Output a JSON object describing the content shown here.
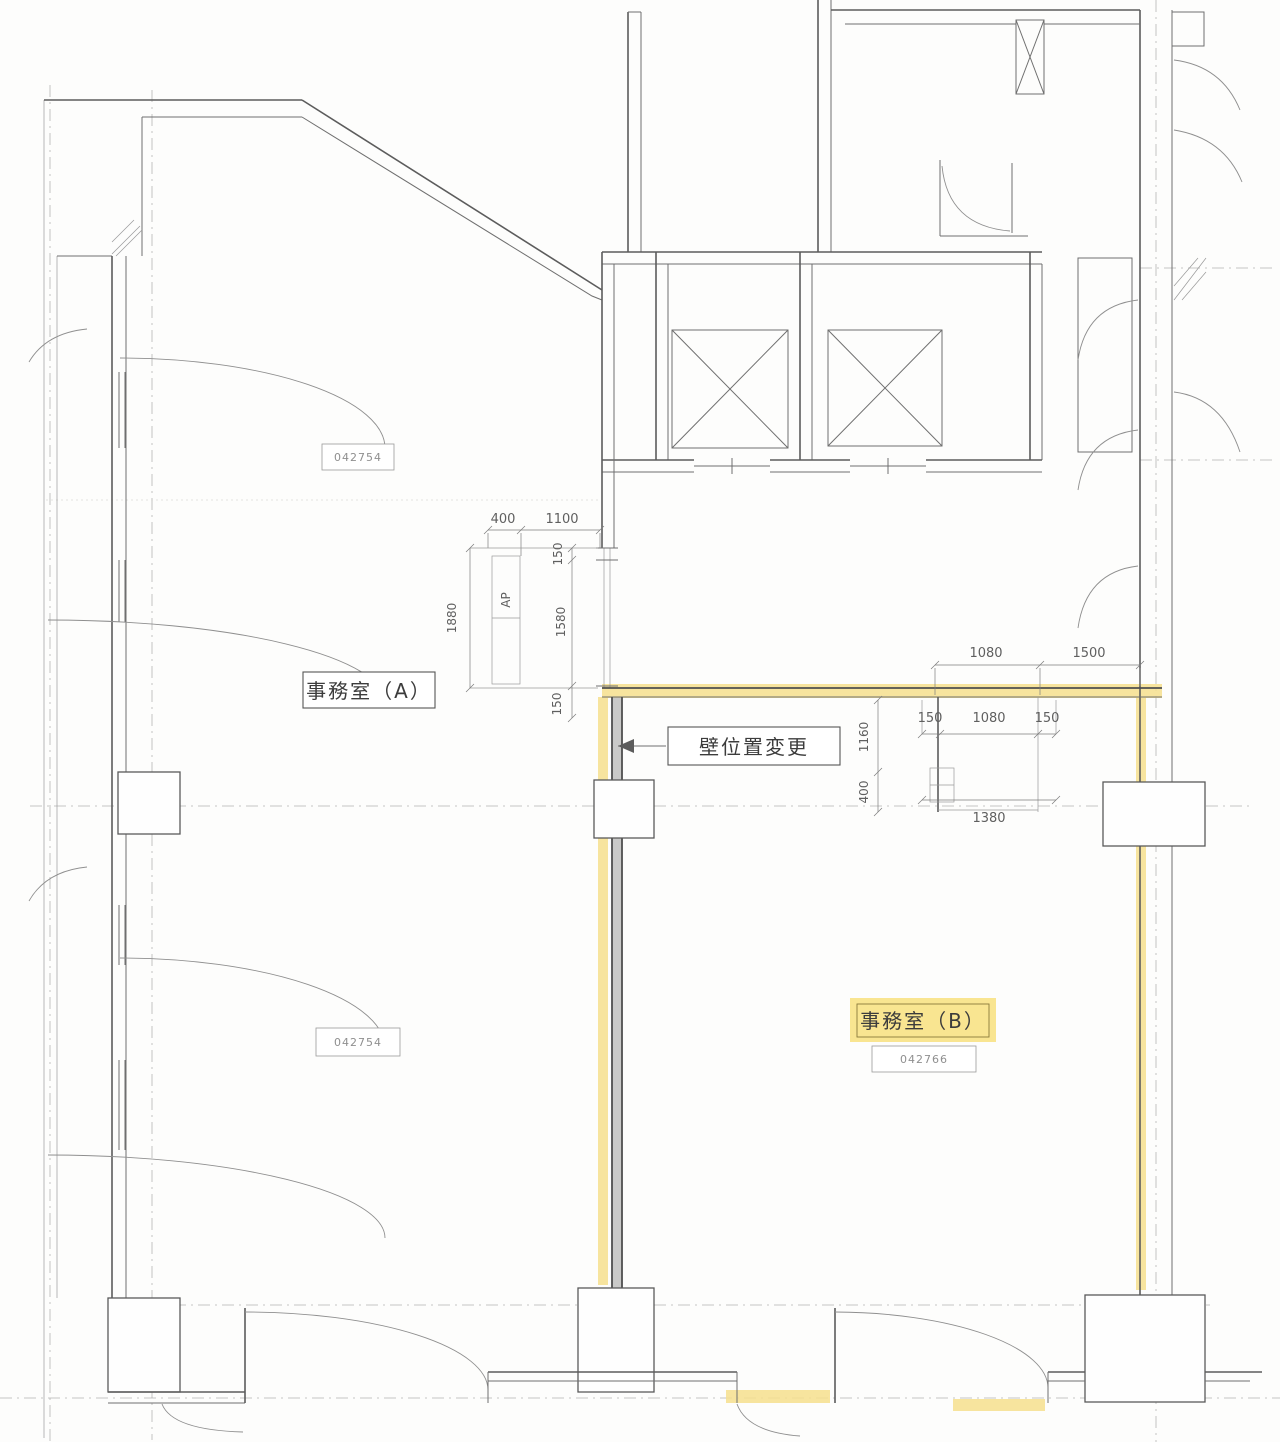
{
  "rooms": {
    "a": {
      "label": "事務室（A）",
      "code_top": "042754",
      "code_bottom": "042754"
    },
    "b": {
      "label": "事務室（B）",
      "code": "042766"
    }
  },
  "annotations": {
    "wall_change": "壁位置変更"
  },
  "dimensions": {
    "left_group": {
      "top_400": "400",
      "top_1100": "1100",
      "v_150_upper": "150",
      "v_1580": "1580",
      "v_1880": "1880",
      "v_150_lower": "150",
      "ap": "AP"
    },
    "right_group": {
      "top_1080": "1080",
      "top_1500": "1500",
      "mid_150_left": "150",
      "mid_1080": "1080",
      "mid_150_right": "150",
      "v_1160": "1160",
      "v_400": "400",
      "bottom_1380": "1380"
    }
  },
  "colors": {
    "highlight": "#f6df8d",
    "room_b_label_bg": "#f8e285",
    "wall_line": "#5c5c5c",
    "dim_text": "#5f5f5f"
  }
}
